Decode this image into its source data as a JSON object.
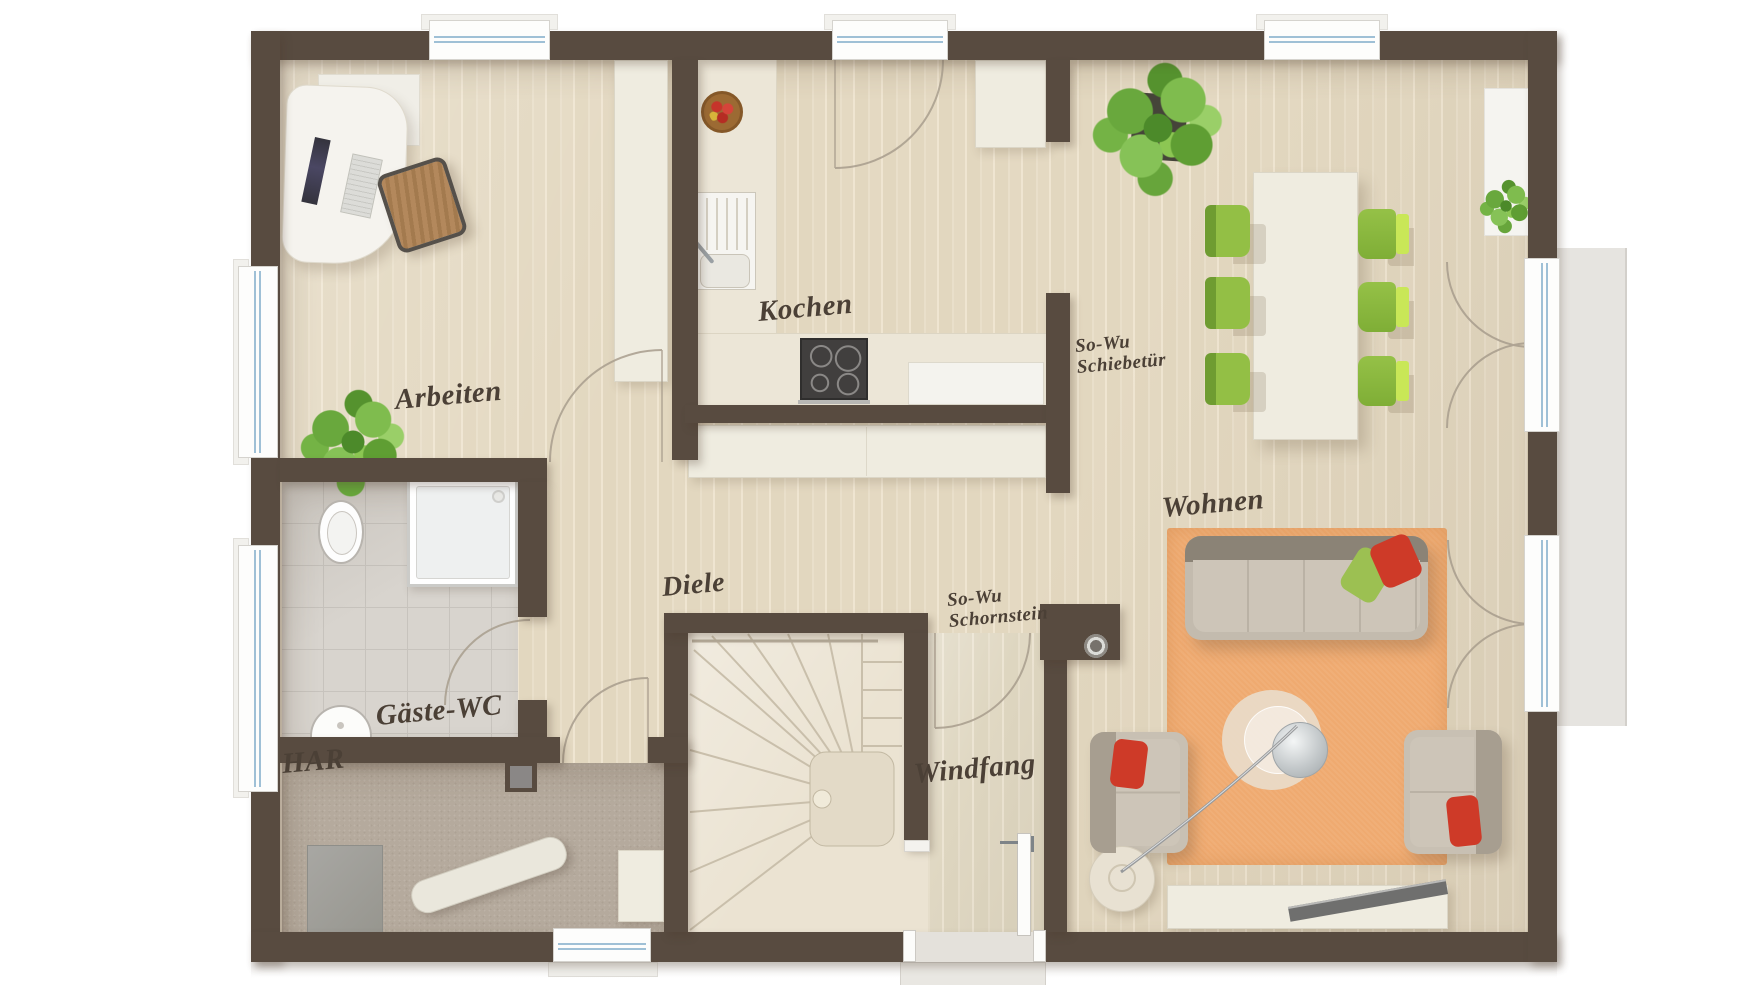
{
  "type": "floor_plan",
  "labels": {
    "arbeiten": "Arbeiten",
    "kochen": "Kochen",
    "wohnen": "Wohnen",
    "diele": "Diele",
    "gaeste_wc": "Gäste-WC",
    "har": "HAR",
    "windfang": "Windfang",
    "schiebetuer": {
      "line1": "So-Wu",
      "line2": "Schiebetür"
    },
    "schornstein": {
      "line1": "So-Wu",
      "line2": "Schornstein"
    }
  },
  "colors": {
    "wall": "#584b40",
    "wood_floor": "#e7dcc6",
    "tile_wc": "#d8d4ce",
    "carpet_har": "#b5aa9d",
    "rug_orange": "#efaa70",
    "dining_chair_green": "#8db842",
    "dining_chair_light_green": "#c9e757",
    "sofa_taupe": "#c3bbae",
    "cushion_red": "#ce3a28",
    "cushion_green": "#9cc052",
    "furniture_cream": "#efece0",
    "terrace_gray": "#e6e4e0",
    "window_glass_blue": "#9fc0d6",
    "plant_green": "#6fae3f",
    "label_text": "#4b4036"
  }
}
